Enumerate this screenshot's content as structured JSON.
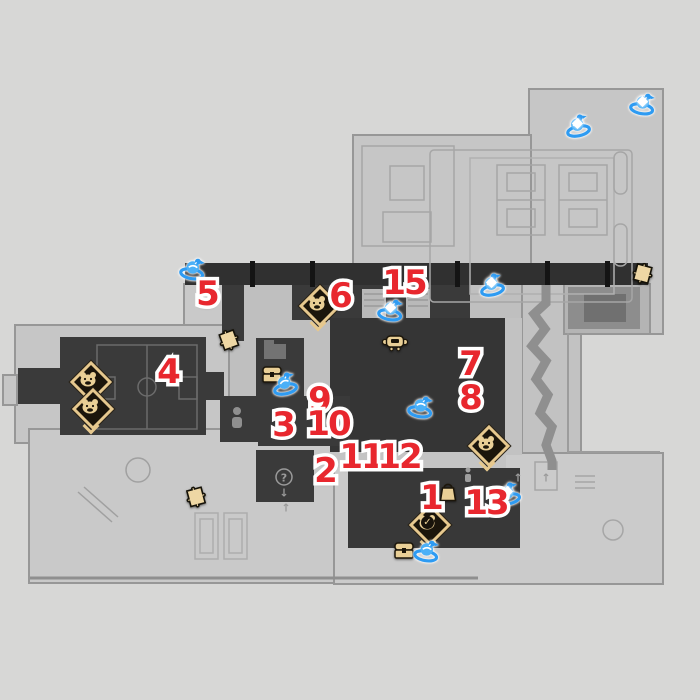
{
  "map": {
    "colors": {
      "marker_red": "#e8272e",
      "bird_blue": "#3fa9f5",
      "gold": "#e9cf96",
      "room_dark": "#3a3a3a",
      "background": "#d6d6d6",
      "checked_glyph": "✓"
    },
    "number_markers": [
      {
        "label": "1",
        "x": 431,
        "y": 498
      },
      {
        "label": "2",
        "x": 325,
        "y": 471
      },
      {
        "label": "3",
        "x": 283,
        "y": 425
      },
      {
        "label": "4",
        "x": 168,
        "y": 372
      },
      {
        "label": "5",
        "x": 207,
        "y": 294
      },
      {
        "label": "6",
        "x": 340,
        "y": 296
      },
      {
        "label": "7",
        "x": 470,
        "y": 364
      },
      {
        "label": "8",
        "x": 470,
        "y": 398
      },
      {
        "label": "9",
        "x": 319,
        "y": 400
      },
      {
        "label": "10",
        "x": 328,
        "y": 424
      },
      {
        "label": "11",
        "x": 361,
        "y": 457
      },
      {
        "label": "12",
        "x": 399,
        "y": 457
      },
      {
        "label": "13",
        "x": 486,
        "y": 503
      },
      {
        "label": "15",
        "x": 404,
        "y": 283
      }
    ],
    "bird_markers": [
      {
        "x": 193,
        "y": 271,
        "sparkle": false
      },
      {
        "x": 578,
        "y": 128,
        "sparkle": true
      },
      {
        "x": 643,
        "y": 106,
        "sparkle": true
      },
      {
        "x": 492,
        "y": 287,
        "sparkle": true
      },
      {
        "x": 391,
        "y": 312,
        "sparkle": true
      },
      {
        "x": 285,
        "y": 386,
        "sparkle": false
      },
      {
        "x": 421,
        "y": 409,
        "sparkle": false
      },
      {
        "x": 508,
        "y": 496,
        "sparkle": true
      },
      {
        "x": 427,
        "y": 553,
        "sparkle": false
      }
    ],
    "enemy_markers": [
      {
        "x": 317,
        "y": 303,
        "face": "raccoon",
        "checked": false,
        "chevron": true
      },
      {
        "x": 88,
        "y": 379,
        "face": "panda",
        "checked": false,
        "chevron": false
      },
      {
        "x": 90,
        "y": 406,
        "face": "tiger",
        "checked": false,
        "chevron": true
      },
      {
        "x": 486,
        "y": 443,
        "face": "monkey",
        "checked": false,
        "chevron": true
      },
      {
        "x": 427,
        "y": 522,
        "face": "monkey",
        "checked": true,
        "chevron": true
      }
    ],
    "puzzle_markers": [
      {
        "x": 230,
        "y": 343,
        "rot": -20
      },
      {
        "x": 197,
        "y": 500,
        "rot": -15
      },
      {
        "x": 643,
        "y": 277,
        "rot": 15
      }
    ],
    "chest_markers": [
      {
        "x": 272,
        "y": 376
      },
      {
        "x": 404,
        "y": 552
      }
    ],
    "bag_markers": [
      {
        "x": 448,
        "y": 494
      }
    ],
    "trotter_markers": [
      {
        "x": 395,
        "y": 345
      }
    ],
    "glyphs": [
      {
        "t": "?",
        "x": 284,
        "y": 478
      },
      {
        "t": "↓",
        "x": 284,
        "y": 493
      },
      {
        "t": "↑",
        "x": 286,
        "y": 508
      },
      {
        "t": "↑",
        "x": 518,
        "y": 478
      },
      {
        "t": "↑",
        "x": 546,
        "y": 478
      }
    ]
  }
}
